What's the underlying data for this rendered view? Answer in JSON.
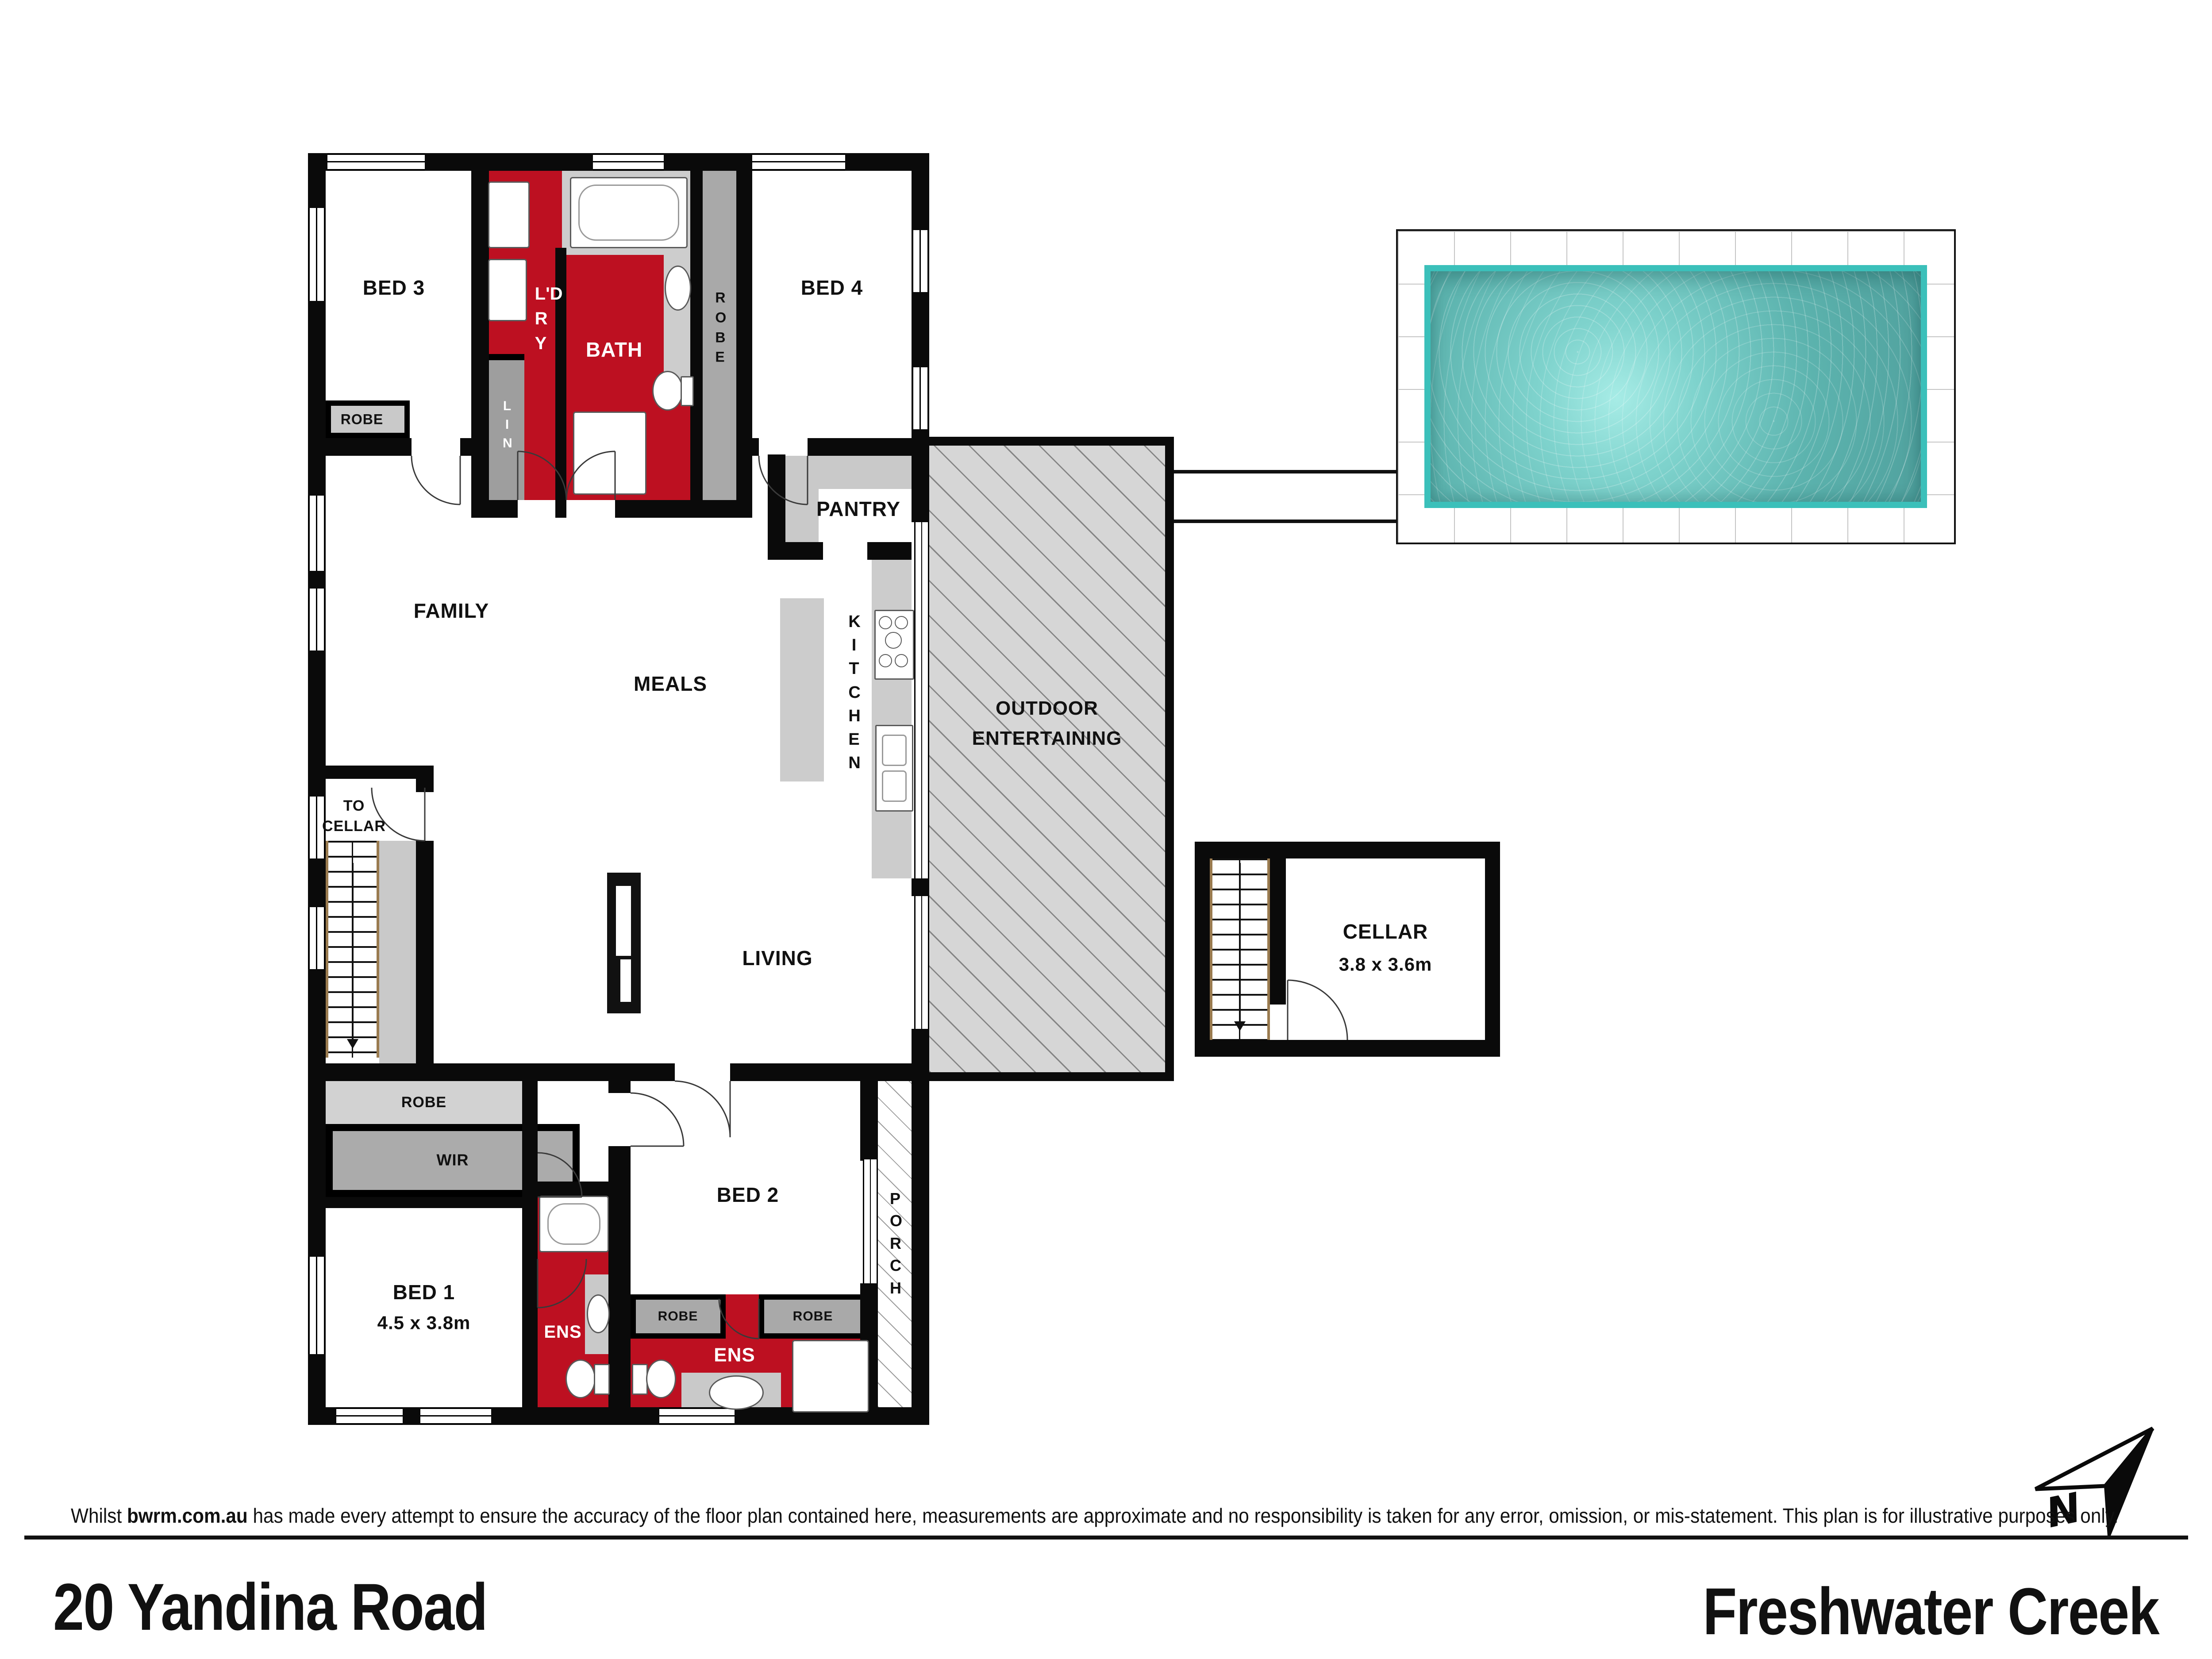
{
  "plan": {
    "rooms": {
      "bed3": "BED 3",
      "robe_bed3": "ROBE",
      "ldry": "L'DRY",
      "lin": "LIN",
      "bath": "BATH",
      "robe_bed4": "ROBE",
      "bed4": "BED 4",
      "pantry": "PANTRY",
      "kitchen": "KITCHEN",
      "family": "FAMILY",
      "meals": "MEALS",
      "outdoor": "OUTDOOR ENTERTAINING",
      "to_cellar": "TO CELLAR",
      "living": "LIVING",
      "cellar": "CELLAR",
      "cellar_dims": "3.8 x 3.6m",
      "robe_hall": "ROBE",
      "wir": "WIR",
      "bed1": "BED 1",
      "bed1_dims": "4.5 x 3.8m",
      "ens_bed1": "ENS",
      "bed2": "BED 2",
      "robe_bed2_left": "ROBE",
      "robe_bed2_right": "ROBE",
      "ens_bed2": "ENS",
      "porch": "PORCH"
    },
    "compass": {
      "north": "N"
    },
    "colors": {
      "wet_area_red": "#bd1021",
      "pool_water": "#6fc9c3",
      "pool_edge": "#3bc0ba",
      "outdoor_hatch_gray": "#d6d6d6",
      "robe_gray": "#c9c9c9",
      "wall_black": "#0a0a0a"
    }
  },
  "footer": {
    "disclaimer_prefix": "Whilst ",
    "disclaimer_brand": "bwrm.com.au",
    "disclaimer_rest": " has made every attempt to ensure the accuracy of the floor plan contained here, measurements  are approximate and no  responsibility is taken for any error, omission, or mis-statement. This plan is for illustrative purposes only.",
    "address": "20 Yandina Road",
    "suburb": "Freshwater Creek"
  }
}
